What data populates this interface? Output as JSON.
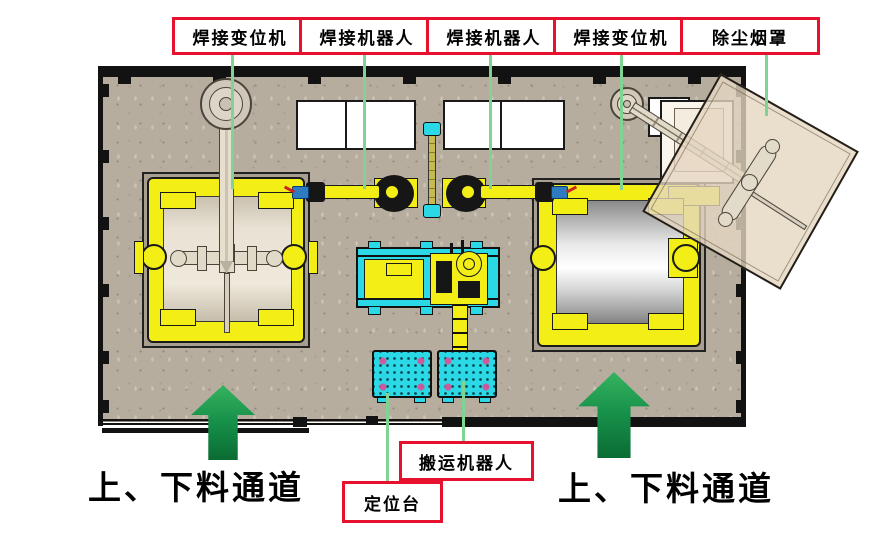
{
  "diagram": {
    "top_labels": [
      {
        "label": "焊接变位机"
      },
      {
        "label": "焊接机器人"
      },
      {
        "label": "焊接机器人"
      },
      {
        "label": "焊接变位机"
      },
      {
        "label": "除尘烟罩"
      }
    ],
    "callouts": {
      "handling_robot": "搬运机器人",
      "positioning_table": "定位台"
    },
    "channels": {
      "left": "上、下料通道",
      "right": "上、下料通道"
    },
    "colors": {
      "label_border_red": "#e8112d",
      "leader_green": "#7fd494",
      "arrow_green": "#17914a",
      "machine_yellow": "#f3ee15",
      "track_cyan": "#2bd9e6",
      "floor_tan": "#b6ad9f",
      "hood_beige": "#e5d6c0",
      "workpiece_beige": "#e9e2d4",
      "torch_blue": "#2e7bc0"
    }
  }
}
